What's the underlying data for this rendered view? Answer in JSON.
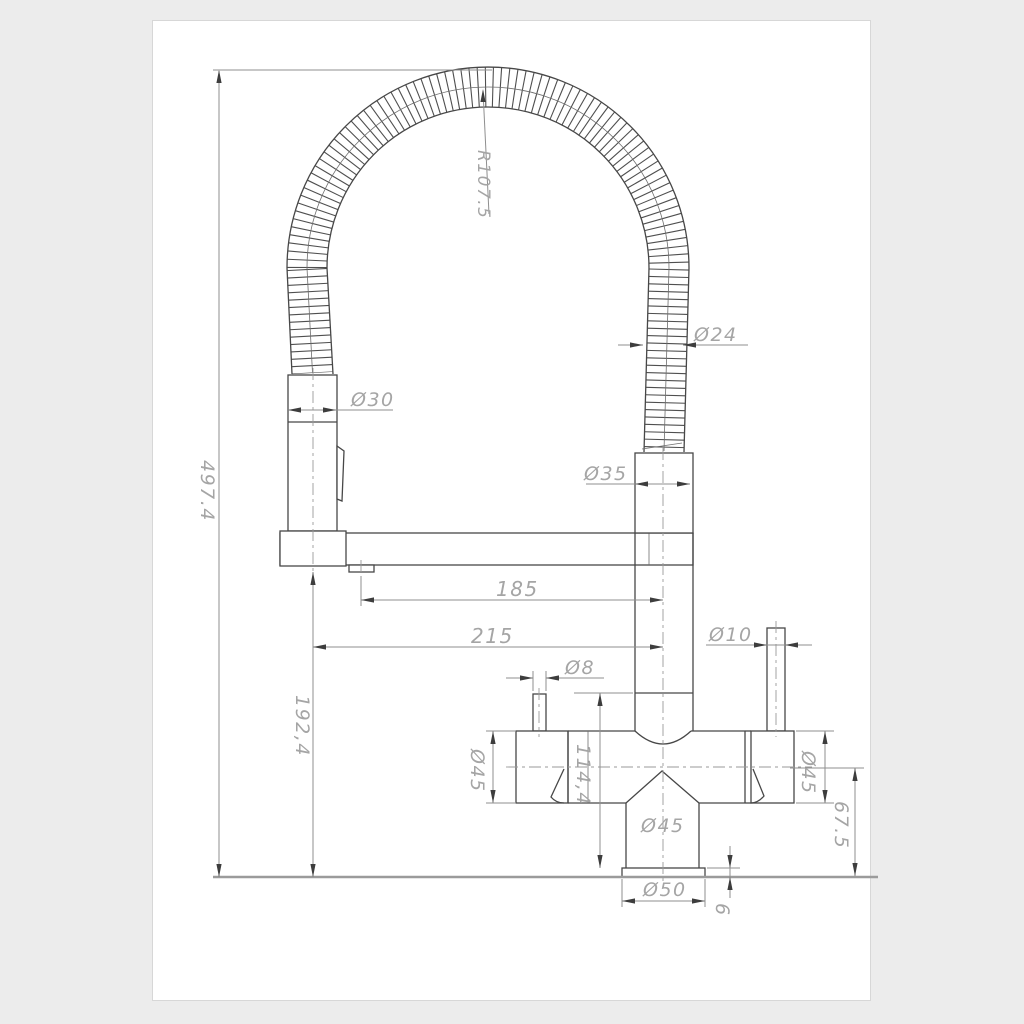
{
  "drawing": {
    "dims": {
      "bend_radius": "R107.5",
      "total_height": "497.4",
      "hose_diameter": "Ø24",
      "sprayer_diameter": "Ø30",
      "connector_diameter": "Ø35",
      "spout_reach": "185",
      "overall_reach": "215",
      "sprayer_outlet_height": "192,4",
      "left_pin_diameter": "Ø8",
      "right_pin_diameter": "Ø10",
      "left_handle_diameter": "Ø45",
      "body_column_height": "114,4",
      "right_handle_diameter": "Ø45",
      "spout_center_height": "67.5",
      "lower_body_diameter": "Ø45",
      "base_diameter": "Ø50",
      "base_height": "6"
    },
    "colors": {
      "part_line": "#474747",
      "dimension_line": "#8f8f8f",
      "label_text": "#a5a5a5",
      "page": "#ffffff",
      "background": "#ececec"
    }
  }
}
